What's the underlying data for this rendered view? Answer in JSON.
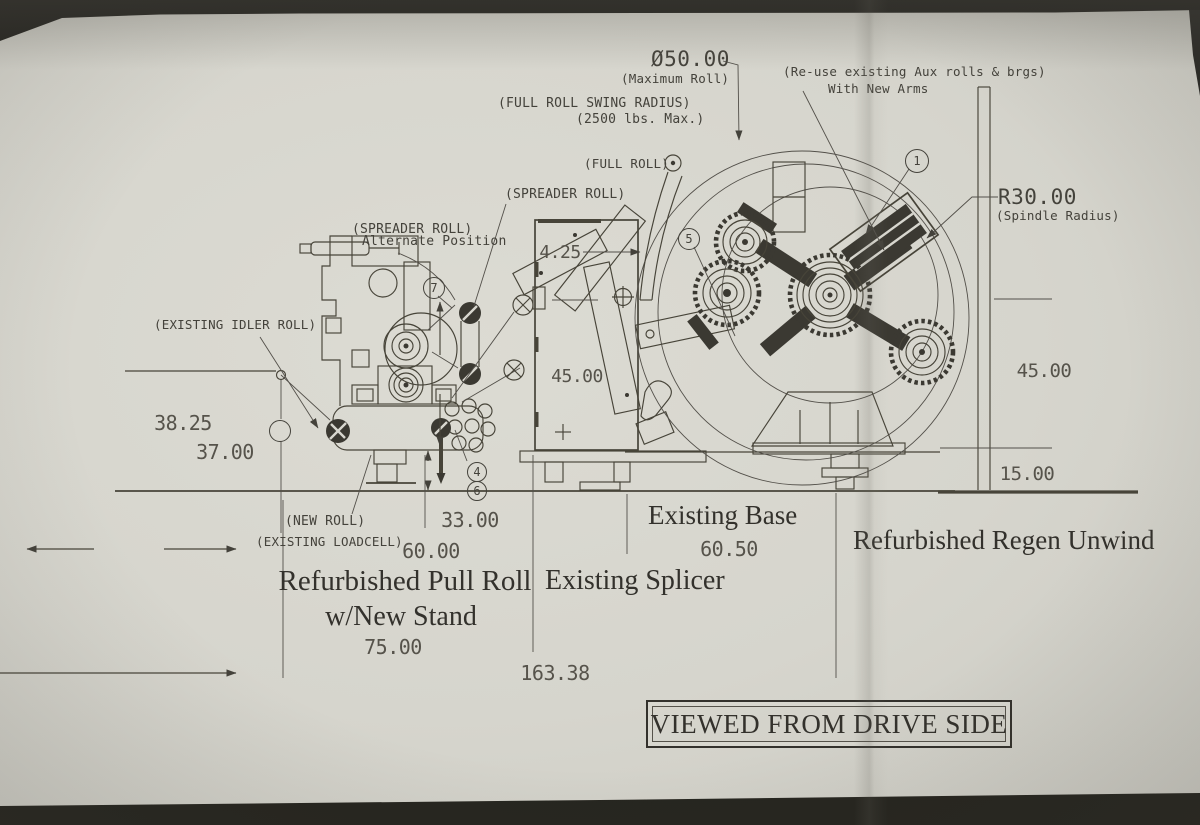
{
  "callouts": {
    "max_roll_dia": "Ø50.00",
    "max_roll": "(Maximum Roll)",
    "swing_radius": "(FULL ROLL SWING RADIUS)",
    "swing_max": "(2500 lbs. Max.)",
    "reuse": "(Re-use existing Aux rolls & brgs)",
    "new_arms": "With New Arms",
    "full_roll": "(FULL ROLL)",
    "spreader_roll": "(SPREADER ROLL)",
    "spreader_roll_alt": "(SPREADER ROLL)",
    "alternate_position": "Alternate Position",
    "existing_idler": "(EXISTING IDLER ROLL)",
    "spindle_radius": "R30.00",
    "spindle_radius_note": "(Spindle Radius)",
    "new_roll": "(NEW ROLL)",
    "existing_loadcell": "(EXISTING LOADCELL)"
  },
  "dimensions": {
    "idler_height": "38.25",
    "roll_height": "37.00",
    "offset": "4.25",
    "splicer_height": "45.00",
    "unwind_height": "45.00",
    "base_height": "15.00",
    "roll_span": "33.00",
    "pullroll_span": "60.00",
    "base_span": "60.50",
    "stand_span": "75.00",
    "total_span": "163.38"
  },
  "machines": {
    "existing_base": "Existing Base",
    "regen_unwind": "Refurbished Regen Unwind",
    "pull_roll_line1": "Refurbished Pull Roll",
    "pull_roll_line2": "w/New Stand",
    "splicer": "Existing Splicer"
  },
  "title_block": {
    "view_note": "VIEWED FROM DRIVE SIDE"
  },
  "balloons": {
    "b1": "1",
    "b4": "4",
    "b5": "5",
    "b6": "6",
    "b7": "7",
    "b_unlabeled": ""
  }
}
